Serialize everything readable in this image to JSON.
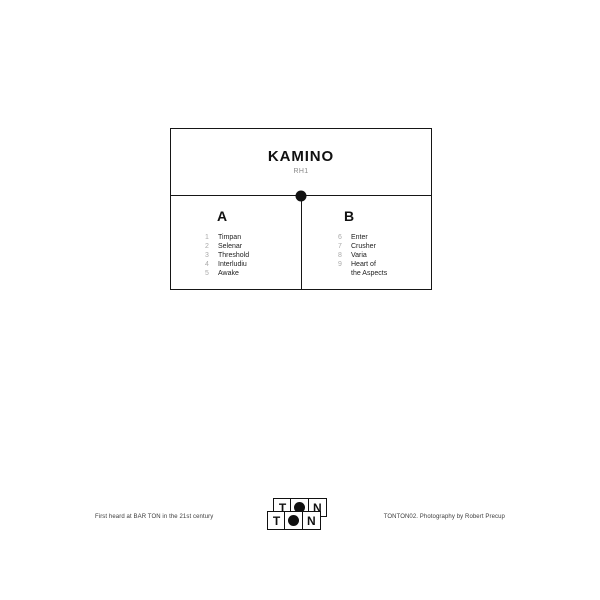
{
  "sleeve": {
    "title": "KAMINO",
    "subtitle": "RH1",
    "sides": [
      {
        "label": "A",
        "tracks": [
          {
            "num": "1",
            "name": "Timpan"
          },
          {
            "num": "2",
            "name": "Selenar"
          },
          {
            "num": "3",
            "name": "Threshold"
          },
          {
            "num": "4",
            "name": "Interludiu"
          },
          {
            "num": "5",
            "name": "Awake"
          }
        ]
      },
      {
        "label": "B",
        "tracks": [
          {
            "num": "6",
            "name": "Enter"
          },
          {
            "num": "7",
            "name": "Crusher"
          },
          {
            "num": "8",
            "name": "Varia"
          },
          {
            "num": "9",
            "name": "Heart of\nthe Aspects"
          }
        ]
      }
    ]
  },
  "footer": {
    "left_note": "First heard at BAR TON in the 21st century",
    "right_note": "TONTON02. Photography by Robert Precup",
    "logo": {
      "back_t": "T",
      "back_n": "N",
      "front_t": "T",
      "front_n": "N"
    }
  },
  "colors": {
    "ink": "#161616",
    "muted_number": "#aaaaaa",
    "subtitle_gray": "#8a8a8a",
    "background": "#ffffff"
  }
}
